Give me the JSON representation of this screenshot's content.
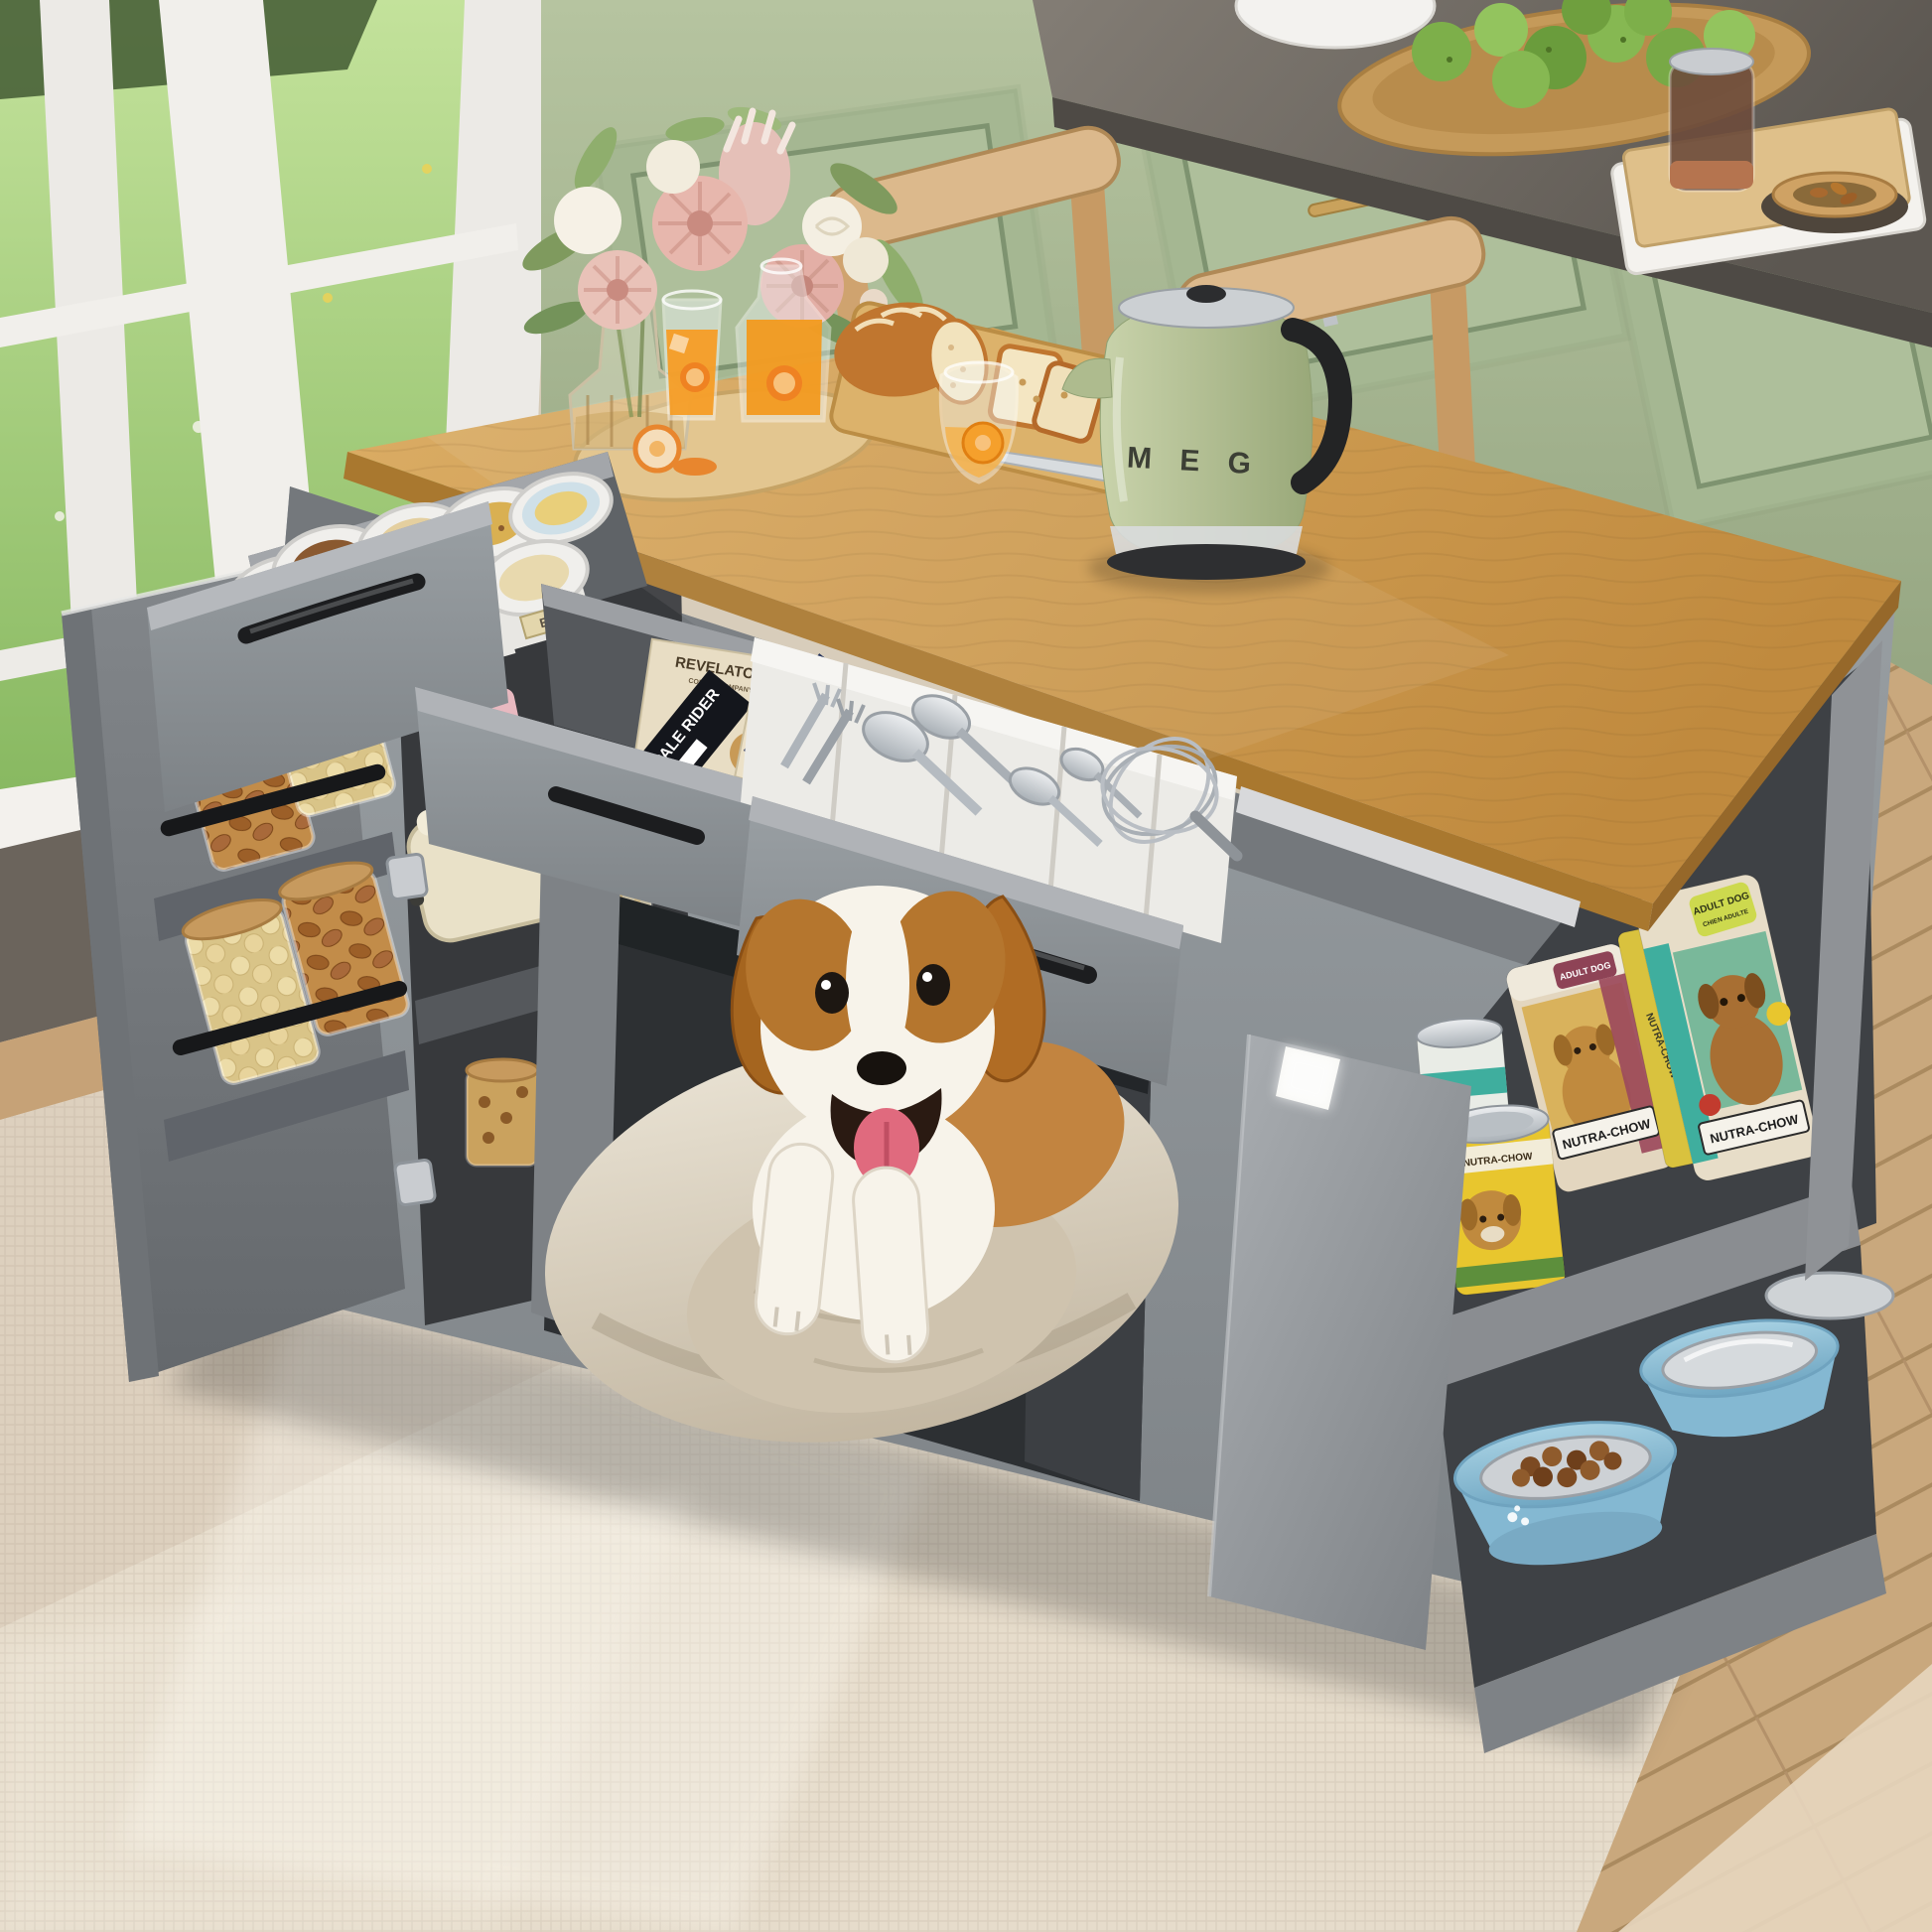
{
  "labels": {
    "tin_label": "E MIX",
    "cookie_brand": "REVELATOR",
    "cookie_brand_sub": "COFFEE COMPANY",
    "cookie_variant": "PALE RIDER",
    "chunks_title": "CHUNKS",
    "chunks_subtitle": "PREMIUM CHOCOLATE FOR DESSERTS AND PASTRIES",
    "kettle_letters": "M E G",
    "dog_food_brand": "NUTRA-CHOW",
    "dog_food_tag": "ADULT DOG",
    "dog_food_tag_fr": "CHIEN ADULTE"
  },
  "colors": {
    "island_gray": "#8b8f93",
    "island_gray_dark": "#5f6367",
    "butcher_block": "#cc9a52",
    "cabinet_green": "#a9ba96",
    "counter_gray": "#6e6862",
    "kettle_green": "#b7c39c",
    "grass_green": "#8fbf6a",
    "rug_cream": "#e6dccb",
    "floor_wood": "#c9a87d",
    "dog_bed": "#d9d0c1",
    "chunks_navy": "#27355c",
    "chunks_red": "#b5342c",
    "bowl_blue": "#8fc0d8"
  },
  "objects": [
    "window-garden-view",
    "green-kitchen-cabinets",
    "back-counter",
    "fruit-plate",
    "dining-chairs",
    "kitchen-island",
    "butcher-block-top",
    "flower-bouquet",
    "orange-juice-set",
    "bread-cutting-board",
    "green-kettle",
    "cookie-tin-drawer",
    "snack-drawer",
    "cutlery-drawer",
    "door-jar-rack",
    "toaster-shelf",
    "dog-bed-nook",
    "beagle-dog",
    "dog-food-shelf",
    "dog-bowl-shelf",
    "area-rug"
  ]
}
